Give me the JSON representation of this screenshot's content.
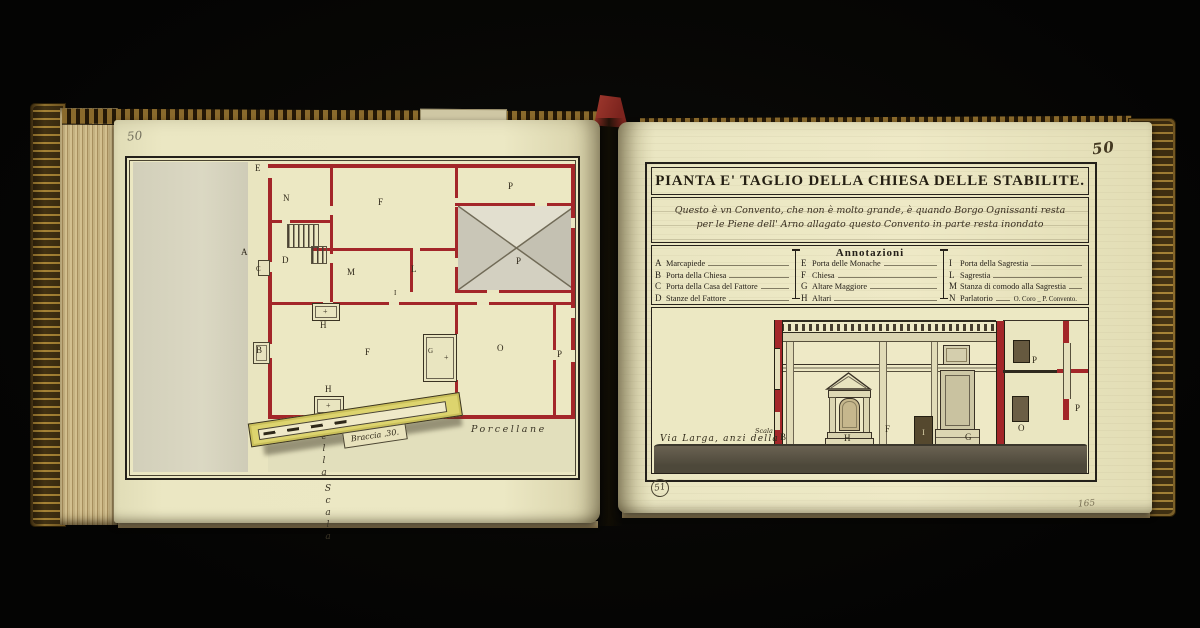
{
  "colors": {
    "paper": "#ece8c4",
    "wall_red": "#a32629",
    "ink": "#2b2416",
    "gold_binding": "#8a6a2c",
    "ground_wash": "#5c5545",
    "street_wash": "#d8d5c0"
  },
  "book": {
    "left_folio": "50",
    "right_folio": "50",
    "plate_number": "51",
    "corner_mark": "165"
  },
  "left_page": {
    "street_vertical": [
      "Via",
      "della",
      "Scala"
    ],
    "street_bottom": [
      "Via",
      "delle",
      "Porcellane"
    ],
    "scale_label": "Braccia .30.",
    "altar_mark": "+",
    "labels": [
      {
        "t": "E"
      },
      {
        "t": "N"
      },
      {
        "t": "F"
      },
      {
        "t": "P"
      },
      {
        "t": "A"
      },
      {
        "t": "C"
      },
      {
        "t": "D"
      },
      {
        "t": "M"
      },
      {
        "t": "L"
      },
      {
        "t": "P"
      },
      {
        "t": "I"
      },
      {
        "t": "H"
      },
      {
        "t": "H"
      },
      {
        "t": "B"
      },
      {
        "t": "F"
      },
      {
        "t": "G"
      },
      {
        "t": "O"
      },
      {
        "t": "P"
      }
    ]
  },
  "right_page": {
    "title": "PIANTA E' TAGLIO DELLA CHIESA DELLE STABILITE.",
    "subtitle_line1": "Questo è vn Convento, che non è molto grande, è quando Borgo Ognissanti resta",
    "subtitle_line2": "per le Piene dell' Arno allagato questo Convento in parte resta inondato",
    "annotations": {
      "heading": "Annotazioni",
      "columns": [
        {
          "items": [
            {
              "key": "A",
              "label": "Marcapiede"
            },
            {
              "key": "B",
              "label": "Porta della Chiesa"
            },
            {
              "key": "C",
              "label": "Porta della Casa del Fattore"
            },
            {
              "key": "D",
              "label": "Stanze del Fattore"
            }
          ]
        },
        {
          "items": [
            {
              "key": "E",
              "label": "Porta delle Monache"
            },
            {
              "key": "F",
              "label": "Chiesa"
            },
            {
              "key": "G",
              "label": "Altare Maggiore"
            },
            {
              "key": "H",
              "label": "Altari"
            }
          ]
        },
        {
          "items": [
            {
              "key": "I",
              "label": "Porta della Sagrestia"
            },
            {
              "key": "L",
              "label": "Sagrestia"
            },
            {
              "key": "M",
              "label": "Stanza di comodo alla Sagrestia"
            },
            {
              "key": "N",
              "label": "Parlatorio",
              "suffix": "O. Coro _ P. Convento."
            }
          ]
        }
      ]
    },
    "elevation": {
      "street_label": "Via Larga, anzi della",
      "stair_label": "Scala",
      "letters": [
        {
          "t": "B"
        },
        {
          "t": "H"
        },
        {
          "t": "F"
        },
        {
          "t": "I"
        },
        {
          "t": "G"
        },
        {
          "t": "O"
        },
        {
          "t": "P"
        },
        {
          "t": "P"
        }
      ]
    }
  }
}
